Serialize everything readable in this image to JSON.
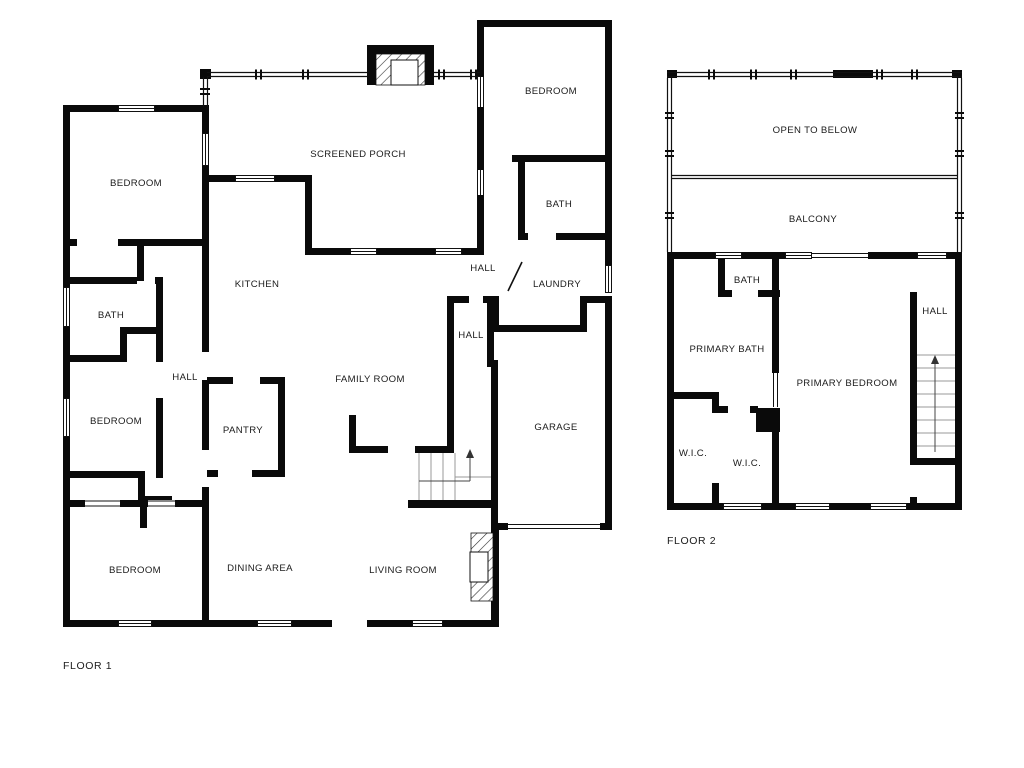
{
  "document": {
    "type": "residential-floor-plan",
    "background": "#ffffff",
    "wall_color": "#0a0a0a"
  },
  "floors": [
    {
      "name": "FLOOR 1",
      "name_pos": {
        "x": 63,
        "y": 669
      },
      "rooms": [
        {
          "id": "bedroom-top-left",
          "label": "BEDROOM",
          "x": 136,
          "y": 186
        },
        {
          "id": "screened-porch",
          "label": "SCREENED PORCH",
          "x": 358,
          "y": 157
        },
        {
          "id": "bedroom-top-right",
          "label": "BEDROOM",
          "x": 551,
          "y": 94
        },
        {
          "id": "bath-right",
          "label": "BATH",
          "x": 559,
          "y": 207
        },
        {
          "id": "hall-upper",
          "label": "HALL",
          "x": 483,
          "y": 271
        },
        {
          "id": "laundry",
          "label": "LAUNDRY",
          "x": 557,
          "y": 287
        },
        {
          "id": "kitchen",
          "label": "KITCHEN",
          "x": 257,
          "y": 287
        },
        {
          "id": "bath-left",
          "label": "BATH",
          "x": 111,
          "y": 318
        },
        {
          "id": "hall-left",
          "label": "HALL",
          "x": 185,
          "y": 380
        },
        {
          "id": "hall-middle",
          "label": "HALL",
          "x": 471,
          "y": 338
        },
        {
          "id": "family-room",
          "label": "FAMILY ROOM",
          "x": 370,
          "y": 382
        },
        {
          "id": "bedroom-mid-left",
          "label": "BEDROOM",
          "x": 116,
          "y": 424
        },
        {
          "id": "pantry",
          "label": "PANTRY",
          "x": 243,
          "y": 433
        },
        {
          "id": "garage",
          "label": "GARAGE",
          "x": 556,
          "y": 430
        },
        {
          "id": "bedroom-bottom-left",
          "label": "BEDROOM",
          "x": 135,
          "y": 573
        },
        {
          "id": "dining-area",
          "label": "DINING AREA",
          "x": 260,
          "y": 571
        },
        {
          "id": "living-room",
          "label": "LIVING ROOM",
          "x": 403,
          "y": 573
        }
      ]
    },
    {
      "name": "FLOOR 2",
      "name_pos": {
        "x": 667,
        "y": 544
      },
      "rooms": [
        {
          "id": "open-to-below",
          "label": "OPEN TO BELOW",
          "x": 815,
          "y": 133
        },
        {
          "id": "balcony",
          "label": "BALCONY",
          "x": 813,
          "y": 222
        },
        {
          "id": "bath-2",
          "label": "BATH",
          "x": 747,
          "y": 283
        },
        {
          "id": "primary-bath",
          "label": "PRIMARY BATH",
          "x": 727,
          "y": 352
        },
        {
          "id": "hall-2",
          "label": "HALL",
          "x": 935,
          "y": 314
        },
        {
          "id": "primary-bedroom",
          "label": "PRIMARY BEDROOM",
          "x": 847,
          "y": 386
        },
        {
          "id": "wic-left",
          "label": "W.I.C.",
          "x": 693,
          "y": 456
        },
        {
          "id": "wic-middle",
          "label": "W.I.C.",
          "x": 747,
          "y": 466
        }
      ]
    }
  ]
}
